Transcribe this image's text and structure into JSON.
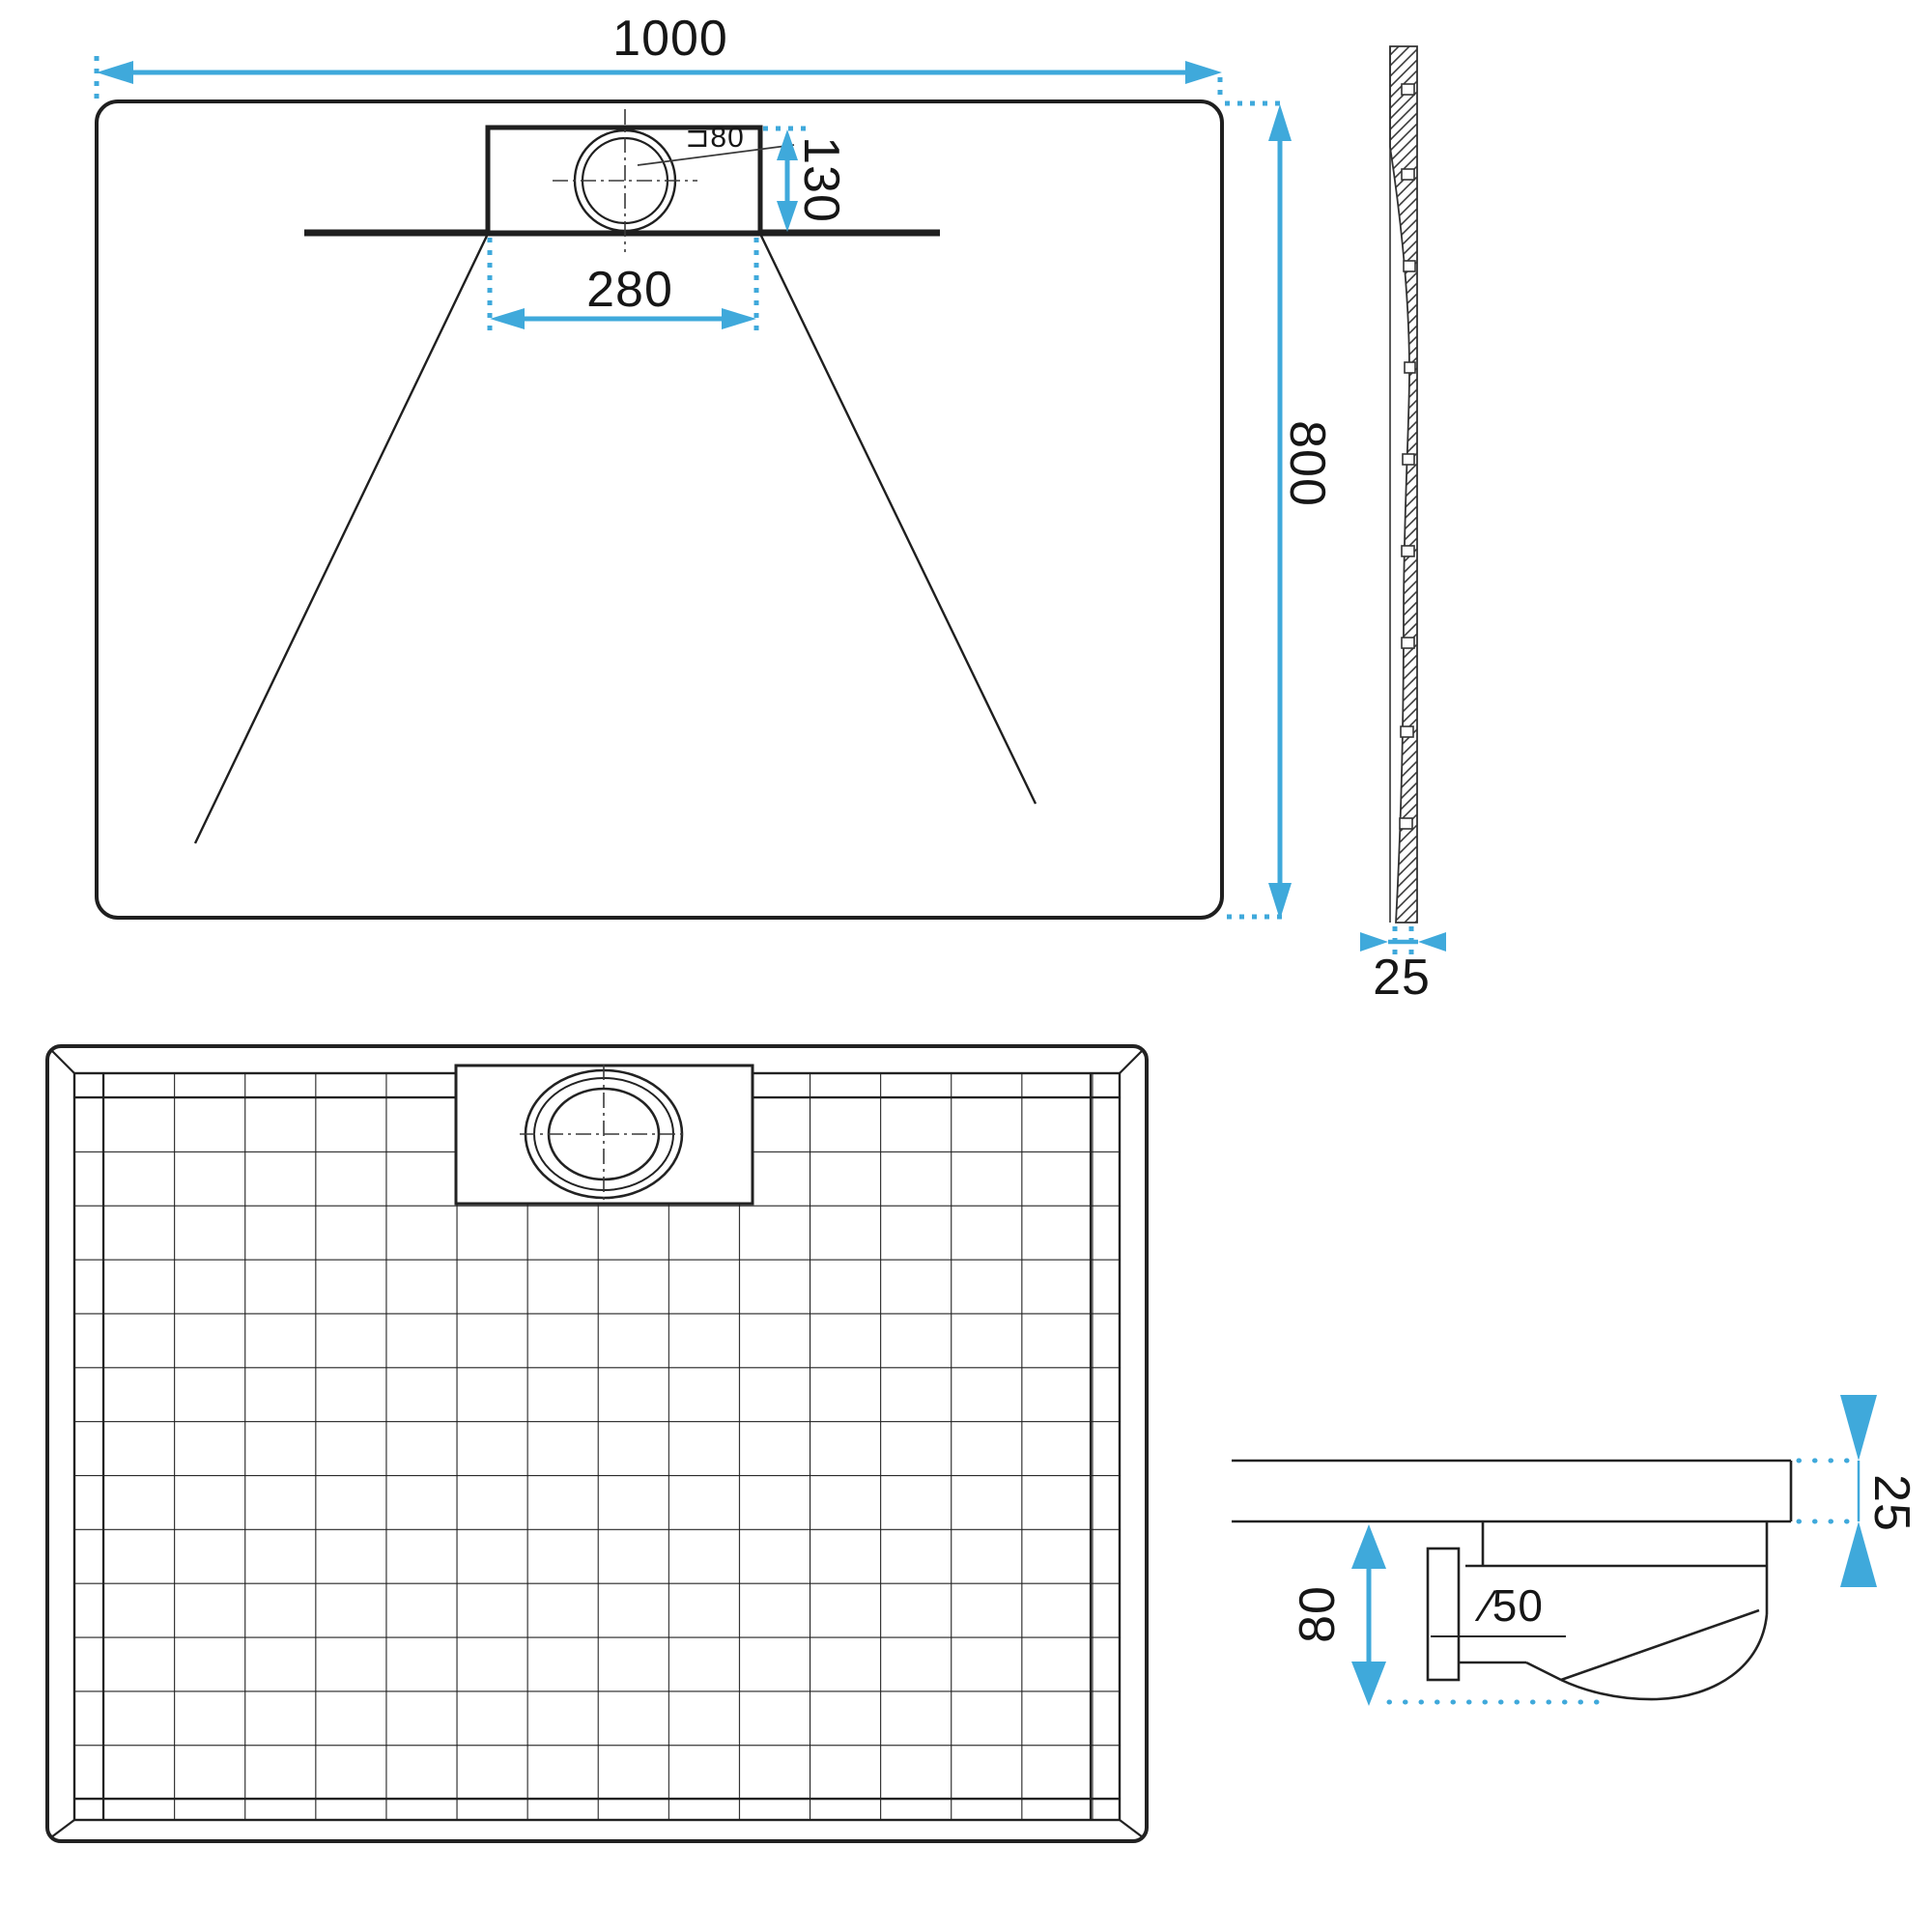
{
  "title": "Shower tray technical drawing",
  "colors": {
    "accent": "#3fa9db",
    "line": "#1f1f1f"
  },
  "plan": {
    "width_label": "1000",
    "height_label": "800",
    "drain_offset_label": "130",
    "drain_width_label": "280",
    "drain_diameter_label": "⊐80"
  },
  "side": {
    "thickness_label": "25"
  },
  "section": {
    "depth_label": "80",
    "pipe_diameter_label": "∕50",
    "thickness_label": "25"
  }
}
